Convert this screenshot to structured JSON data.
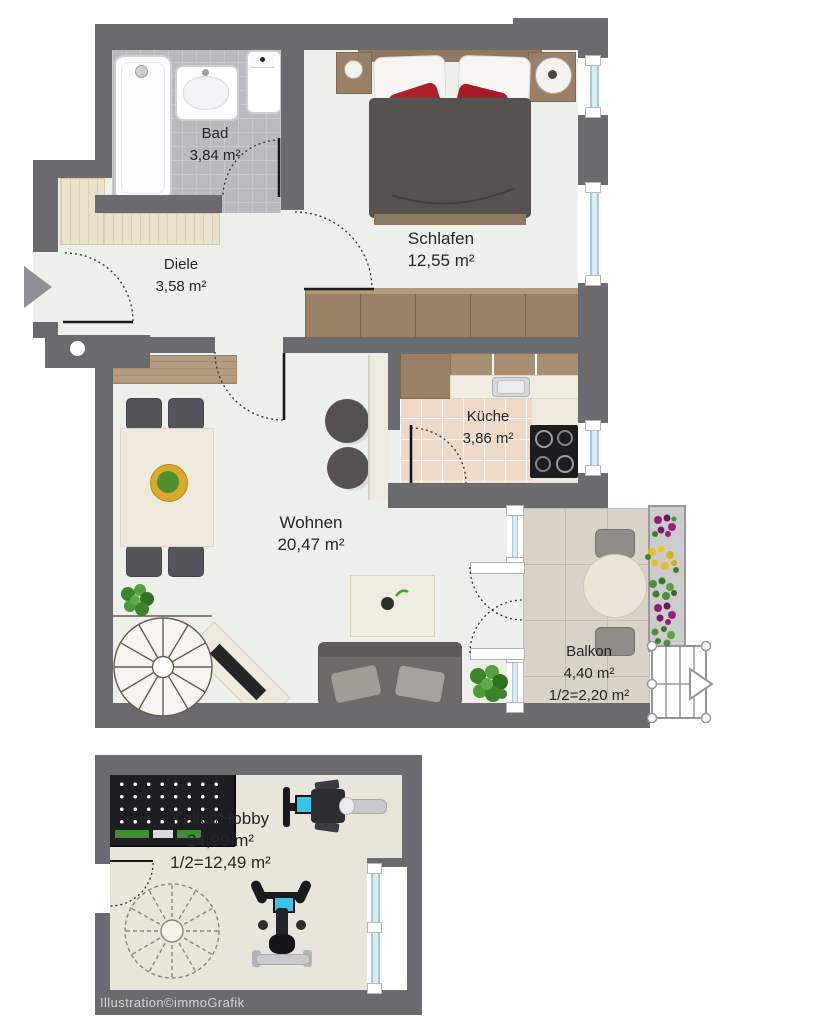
{
  "watermark": "Illustration©immoGrafik",
  "rooms": {
    "bad": {
      "name": "Bad",
      "area": "3,84 m²"
    },
    "diele": {
      "name": "Diele",
      "area": "3,58 m²"
    },
    "schlafen": {
      "name": "Schlafen",
      "area": "12,55 m²"
    },
    "kueche": {
      "name": "Küche",
      "area": "3,86 m²"
    },
    "wohnen": {
      "name": "Wohnen",
      "area": "20,47 m²"
    },
    "balkon": {
      "name": "Balkon",
      "area": "4,40 m²",
      "area_half": "1/2=2,20 m²"
    },
    "keller": {
      "name": "Keller/Hobby",
      "area": "24,99 m²",
      "area_half": "1/2=12,49 m²"
    }
  },
  "colors": {
    "wall": "#6a6a6f",
    "floor": "#edefeb",
    "bath_tile": "#b9babe",
    "kitchen_tile": "#ecd9c9",
    "keller_floor": "#e9e5da",
    "balcony_floor": "#d8d2c8",
    "wood_dark": "#9a8064",
    "wood_light": "#e9e1cd",
    "accent_red": "#b0202a",
    "window_glass": "#d7ecf4",
    "plant_green": "#4c9a34",
    "display_cyan": "#3bc3e8"
  }
}
